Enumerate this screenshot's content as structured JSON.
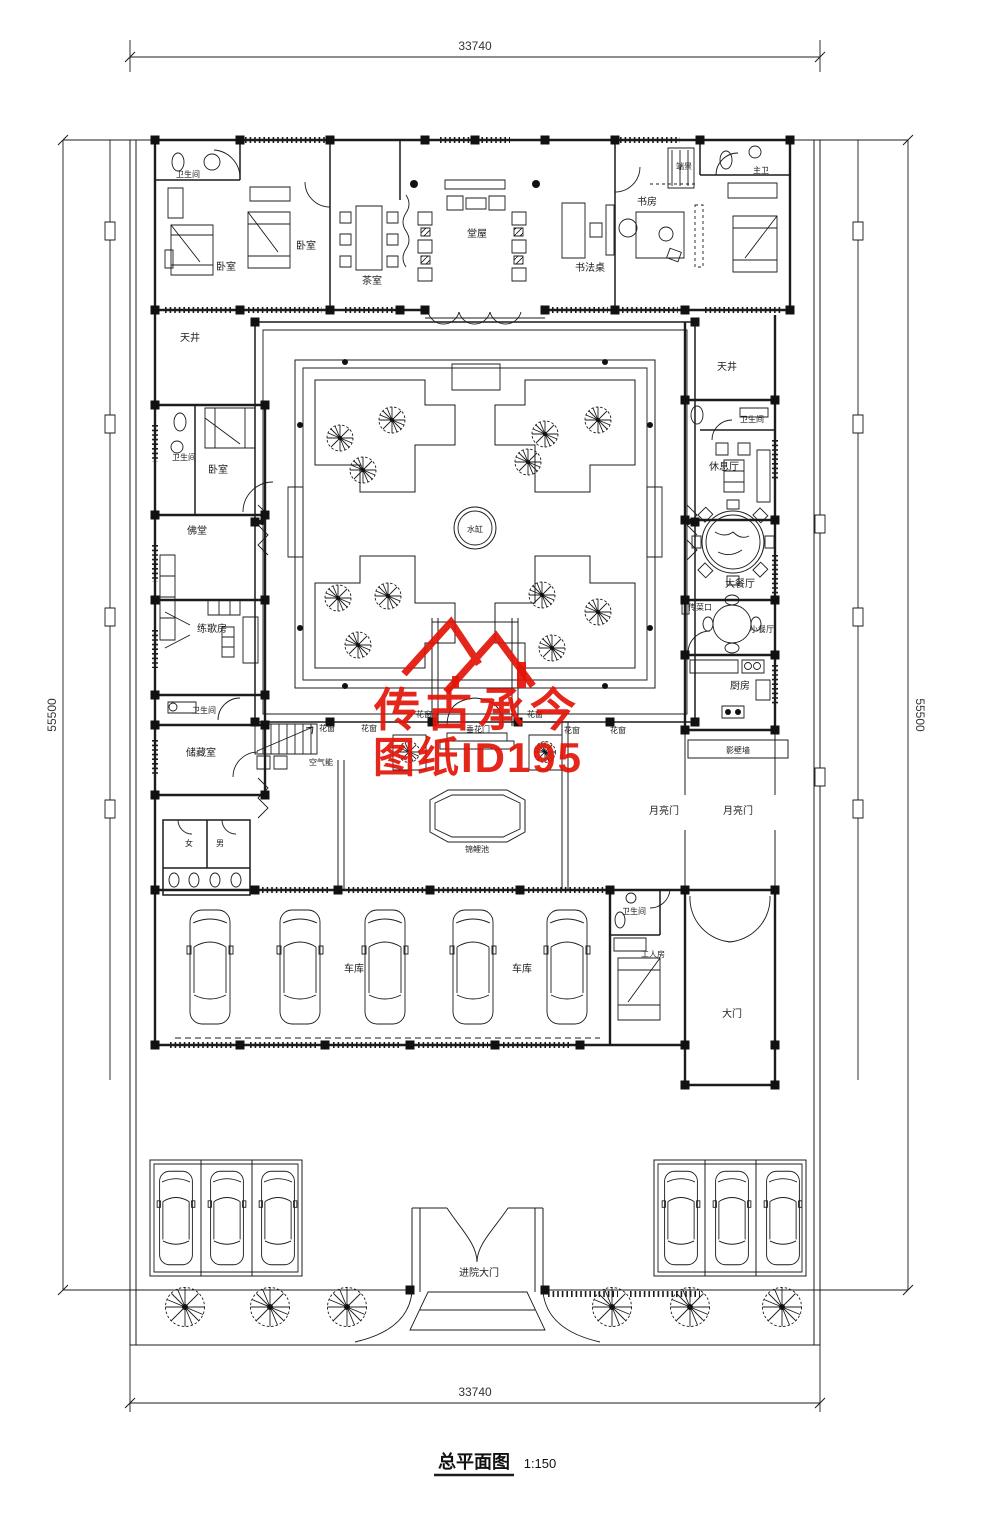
{
  "title": {
    "text": "总平面图",
    "scale": "1:150"
  },
  "dimensions": {
    "top": "33740",
    "bottom": "33740",
    "left": "55500",
    "right": "55500"
  },
  "watermark": {
    "brand": "传古承今",
    "sheet_id": "图纸ID195",
    "color": "#e31408"
  },
  "rooms": {
    "bathroom_top_left": "卫生间",
    "bedroom_1": "卧室",
    "bedroom_2": "卧室",
    "tea_room": "茶室",
    "main_hall": "堂屋",
    "calligraphy_desk": "书法桌",
    "study": "书房",
    "end_view": "端景",
    "master_bath": "主卫",
    "lightwell_left": "天井",
    "lightwell_right": "天井",
    "bathroom_mid_left": "卫生间",
    "bedroom_3": "卧室",
    "buddhist_hall": "佛堂",
    "karaoke_room": "练歌房",
    "bathroom_lower_left": "卫生间",
    "storage": "储藏室",
    "air_heat_pump": "空气能",
    "women": "女",
    "men": "男",
    "bathroom_right": "卫生间",
    "lounge": "休息厅",
    "dining_large": "大餐厅",
    "food_pass": "传菜口",
    "dining_small": "小餐厅",
    "kitchen": "厨房",
    "screen_wall": "影壁墙",
    "moon_gate": "月亮门",
    "koi_pond": "锦鲤池",
    "garage": "车库",
    "bathroom_worker": "卫生间",
    "worker_room": "工人房",
    "main_gate": "大门",
    "entrance_gate": "进院大门",
    "water_vat": "水缸",
    "hanging_flower_gate": "垂花门",
    "lattice_window": "花窗"
  }
}
